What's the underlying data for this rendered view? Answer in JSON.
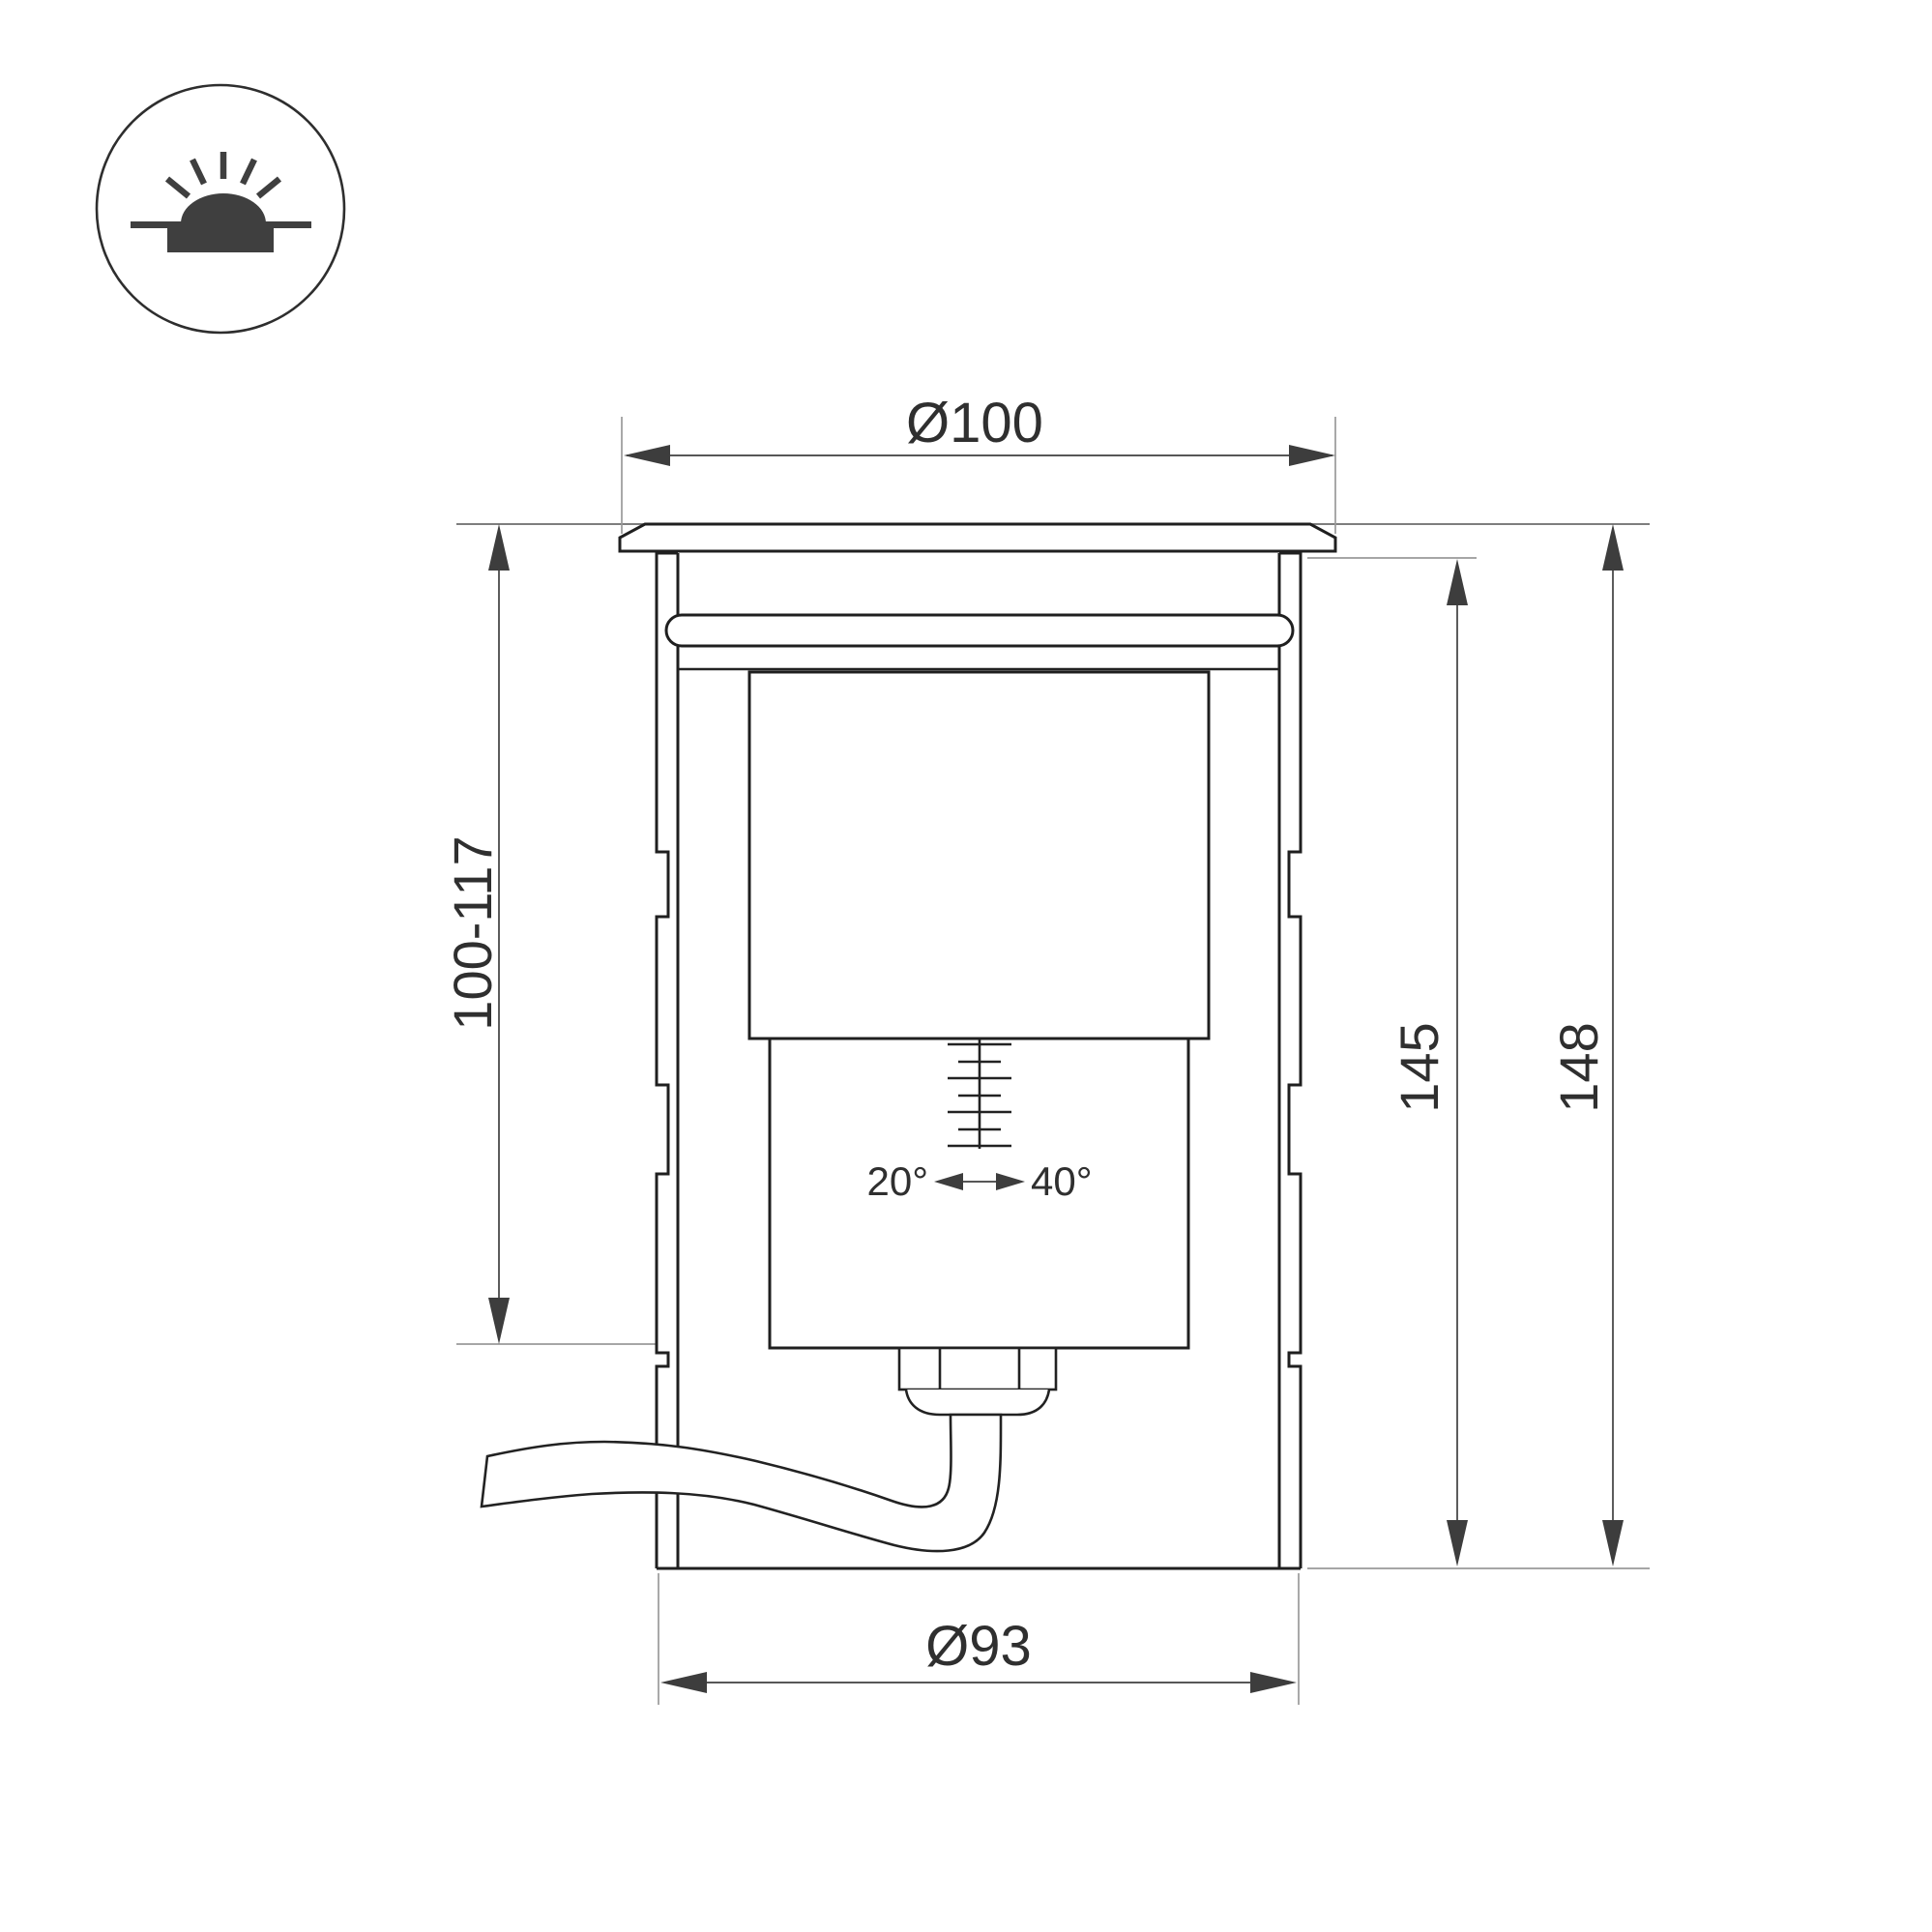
{
  "page": {
    "background": "#ffffff"
  },
  "icon_badge": {
    "name": "recessed-ground-luminaire-icon"
  },
  "drawing": {
    "labels": {
      "top_diameter": "Ø100",
      "recess_depth": "100-117",
      "height_body": "145",
      "height_overall": "148",
      "bottom_diameter": "Ø93",
      "tilt_min": "20°",
      "tilt_max": "40°"
    },
    "colors": {
      "object_line": "#1f1f1f",
      "dimension_line": "#3f3f3f",
      "extension_line": "#9a9a9a",
      "ground_line": "#6b6b6b",
      "arrow_fill": "#3d3d3d",
      "icon_glyph": "#3f3f3f",
      "label_text": "#2f2f2f",
      "background": "#ffffff"
    }
  }
}
